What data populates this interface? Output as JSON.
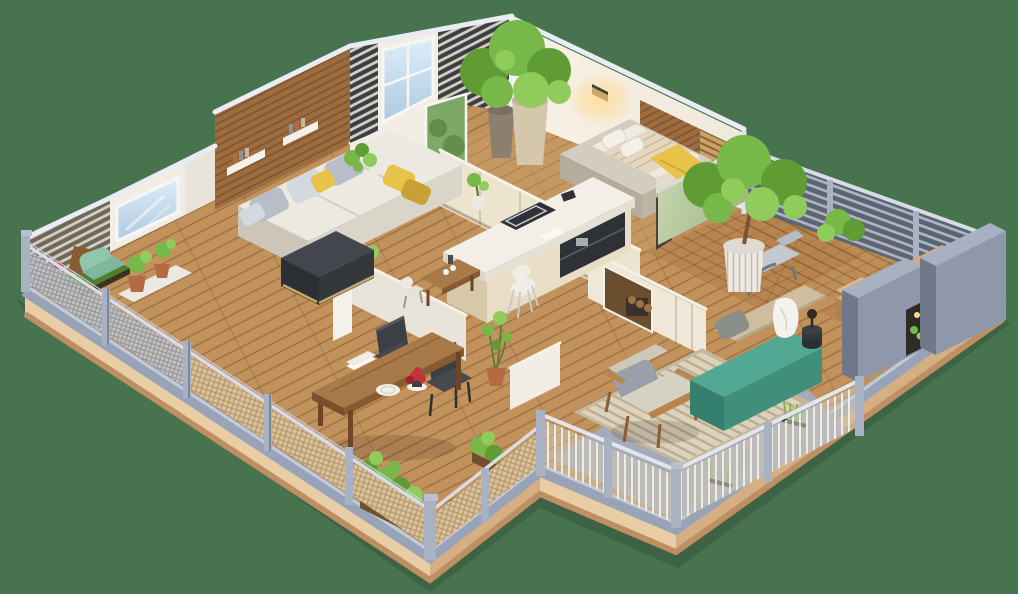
{
  "scene": {
    "type": "isometric-3d-floor-plan-render",
    "description": "Cutaway 3D isometric floor plan of an apartment with wraparound terraces",
    "rooms": [
      "left-balcony",
      "living-room",
      "breakfast-nook",
      "kitchen",
      "small-bedroom",
      "master-bedroom",
      "fireplace-hall",
      "patio",
      "dining-terrace",
      "right-balcony"
    ],
    "furniture": [
      "sectional-sofa",
      "dark-ottoman",
      "kitchen-island",
      "bar-stool",
      "nook-table",
      "dining-table",
      "dining-chairs",
      "single-bed",
      "outdoor-daybed",
      "teal-bench",
      "wooden-armchair",
      "lounge-chair",
      "mint-lounger",
      "planter-boxes",
      "potted-trees"
    ],
    "plants": [
      "corner-ficus-tree",
      "bedroom-ficus-tree",
      "balcony-shrub",
      "grass-planter",
      "succulent-pots",
      "sill-plant",
      "hall-plant",
      "terrace-shrubs"
    ]
  },
  "palette": {
    "bg": "#48734F",
    "shadow": "#35543C",
    "plinthLight": "#E9CDA4",
    "plinthDark": "#D5AF82",
    "plinthEdge": "#BD8F63",
    "curb": "#99A3B7",
    "curbLight": "#C9CFDC",
    "floorWood": "#C2925C",
    "floorBed2": "#B07A45",
    "floorBalcony": "#B98A52",
    "tintInterior": "#CDA069",
    "wallWhite": "#F2EEE6",
    "wallShade": "#E9E4DA",
    "wallBright": "#F4F1EA",
    "wallCap": "#E9ECF3",
    "woodWall": "#9C6B3E",
    "slatBgDark": "#3A3F47",
    "slatBgWarm": "#6E675C",
    "slatLight": "#D8CFBE",
    "slatWoodBg": "#C9A269",
    "railDarkBg": "#5B6372",
    "railPost": "#A9B2C2",
    "railPostDark": "#7E8798",
    "railTop": "#D7DCE6",
    "meshTan": "#D9C19B",
    "meshSilver": "#C3C6CB",
    "slabGray": "#8E98AA",
    "slabGrayLight": "#A8B1C1",
    "slabGrayDark": "#6F7889",
    "glassGreen": "#7FA866",
    "windowFrame": "#F6F6F4",
    "sofaTop": "#ECE9E1",
    "sofaFront": "#DAD5C9",
    "sofaSide": "#CCC6B8",
    "pillowGray": "#B7BEC8",
    "pillowLight": "#D4D9E0",
    "pillowDark": "#99A0A9",
    "accentYellow": "#E9C249",
    "accentYellowDk": "#C8A035",
    "ottoman": "#43464C",
    "ottomanFront": "#34373C",
    "ottomanSide": "#2C2F33",
    "gold": "#C9A86A",
    "islandTop": "#F3EFE6",
    "islandFace": "#E9DDC5",
    "islandSide": "#D8C8AA",
    "counterDark": "#2E3136",
    "steel": "#C6CBD2",
    "stone": "#D3CCC0",
    "stoneSide": "#BDB4A4",
    "mattress": "#F0EBE0",
    "blanket": "#E5D8BF",
    "sage": "#BCCDA6",
    "sageShade": "#A3B78D",
    "teal": "#53A893",
    "tealFront": "#3F8F7B",
    "tealSide": "#347F6D",
    "backrestBeige": "#CFBD9F",
    "tanCushion": "#D4AA79",
    "tanCushionShade": "#BD9260",
    "platformWood": "#B9854C",
    "rug": "#DDD2BB",
    "rugBorder": "#C4B89C",
    "patioDeck": "#A3ACBE",
    "tableWood": "#A87949",
    "tableWoodDk": "#875A31",
    "legWood": "#6E4526",
    "chairDark": "#3C3F45",
    "chairDarkTop": "#55585E",
    "green1": "#5F9C33",
    "green2": "#77B848",
    "green3": "#8FCC5C",
    "greenDark": "#4E7A35",
    "potWhite": "#ECE9E2",
    "potBeige": "#D5C7AC",
    "potBeigeDk": "#C4B49A",
    "potGray": "#8B7F6E",
    "potTerra": "#B56A42",
    "trunk": "#7A5430",
    "cloth": "#F4F2EC",
    "log": "#9A7347",
    "fireDark": "#6B4E2F",
    "crateDark": "#3A322A",
    "doorDark": "#4A4238",
    "sconceGold": "#C9A86A",
    "mint": "#8FC6AC",
    "mintDark": "#7FB89C",
    "grayChair": "#C2C9D2",
    "red": "#C8303C",
    "cream": "#EFE8D9",
    "cushionLight": "#D5D1C3"
  }
}
